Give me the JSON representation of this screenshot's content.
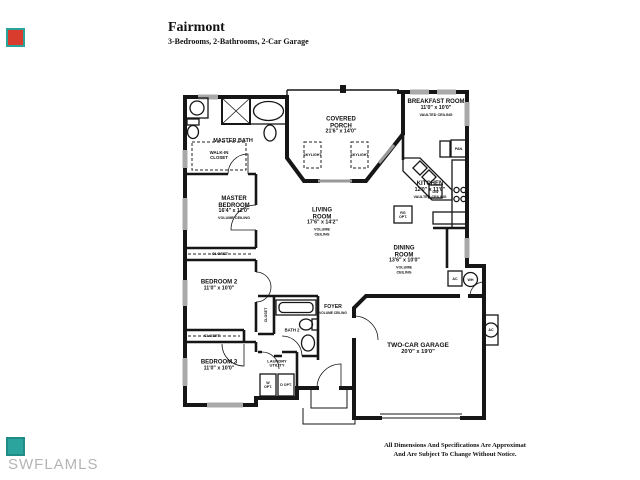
{
  "header": {
    "title": "Fairmont",
    "subtitle": "3-Bedrooms, 2-Bathrooms, 2-Car Garage"
  },
  "watermark": "SWFLAMLS",
  "disclaimer": {
    "line1": "All Dimensions And Specifications Are Approximat",
    "line2": "And Are Subject To Change Without Notice."
  },
  "colors": {
    "corner_red": "#d93b2c",
    "corner_teal": "#2aa49c",
    "walls": "#161616",
    "watermark_gray": "#b5b5b5"
  },
  "rooms": {
    "master_bath": {
      "name": "MASTER BATH"
    },
    "walkin_closet": {
      "name": "WALK-IN CLOSET"
    },
    "covered_porch": {
      "name": "COVERED PORCH",
      "dims": "21'6\" x 14'0\""
    },
    "skylight": {
      "name": "SKYLIGHT"
    },
    "breakfast_room": {
      "name": "BREAKFAST ROOM",
      "dims": "11'0\" x 10'0\"",
      "ceiling": "VAULTED CEILING"
    },
    "kitchen": {
      "name": "KITCHEN",
      "dims": "12'0\" x 11'0\"",
      "ceiling": "VAULTED CEILING"
    },
    "living_room": {
      "name": "LIVING ROOM",
      "dims": "17'6\" x 14'2\"",
      "ceiling": "VOLUME CEILING"
    },
    "dining_room": {
      "name": "DINING ROOM",
      "dims": "13'6\" x 10'0\"",
      "ceiling": "VOLUME CEILING"
    },
    "master_bedroom": {
      "name": "MASTER BEDROOM",
      "dims": "16'4\" x 12'0\"",
      "ceiling": "VOLUME CEILING"
    },
    "bedroom2": {
      "name": "BEDROOM 2",
      "dims": "11'0\" x 10'0\""
    },
    "bedroom3": {
      "name": "BEDROOM 3",
      "dims": "11'0\" x 10'0\""
    },
    "foyer": {
      "name": "FOYER",
      "ceiling": "VOLUME CEILING"
    },
    "bath2": {
      "name": "BATH 2"
    },
    "laundry": {
      "name": "LAUNDRY UTILITY"
    },
    "garage": {
      "name": "TWO-CAR GARAGE",
      "dims": "20'0\" x 19'0\""
    },
    "closet": {
      "name": "CLOSET"
    }
  },
  "fixtures": {
    "pantry": "PAN.",
    "washer_opt": "W OPT.",
    "dryer_opt": "D OPT.",
    "air_handler": "AC",
    "water_heater": "WH",
    "condenser": "AC",
    "range_opt": "RG OPT.",
    "dishwasher": "DW"
  }
}
